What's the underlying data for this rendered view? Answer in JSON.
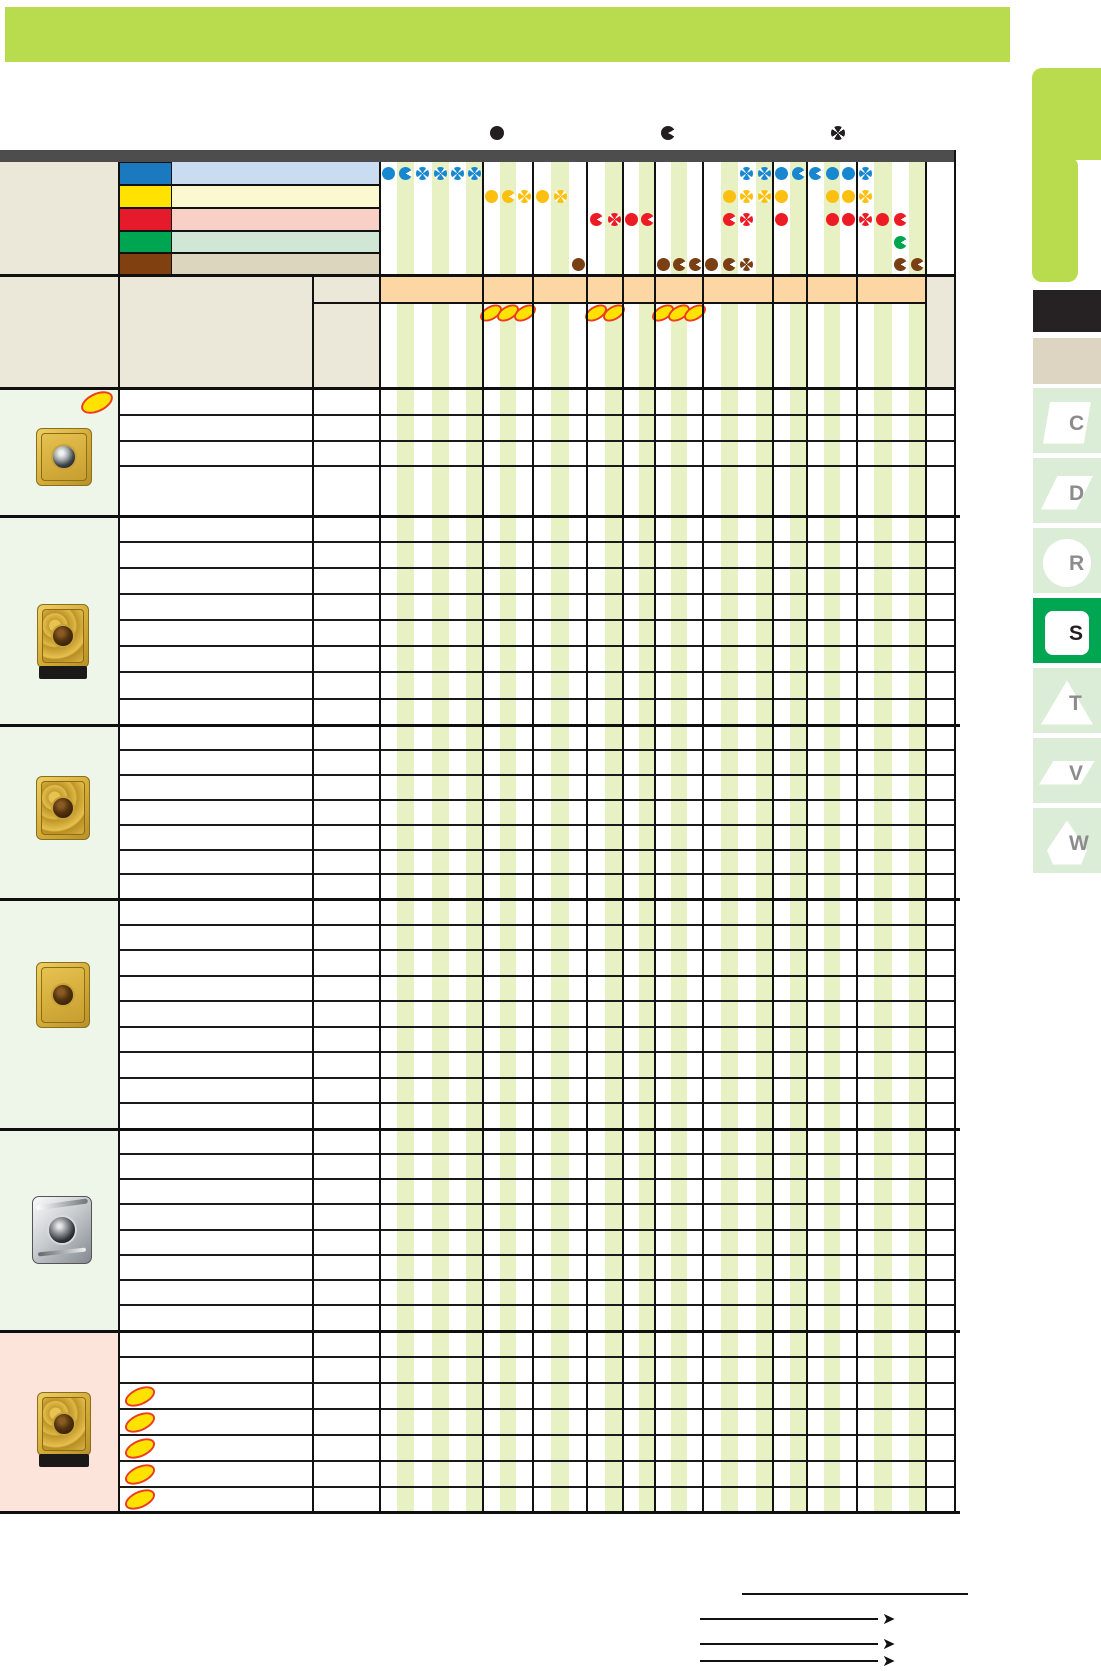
{
  "page": {
    "banner_color": "#b9dc4e",
    "topbar_color": "#4d4d4d",
    "stripe_color": "#e7f1c3",
    "beige_color": "#ebe8da",
    "left_tint_color": "#eef6e9",
    "pink_tint_color": "#fce4db",
    "band_color": "#fcd7a3"
  },
  "legend": {
    "symbols": [
      {
        "name": "first-choice-circle-icon",
        "type": "circle",
        "x": 497
      },
      {
        "name": "second-choice-pacman-icon",
        "type": "pacman",
        "x": 668
      },
      {
        "name": "third-choice-cross-icon",
        "type": "cross",
        "x": 838
      }
    ],
    "color": "#231f20",
    "y": 133,
    "size": 14
  },
  "grid": {
    "groups": [
      6,
      3,
      3,
      2,
      2,
      3,
      4,
      2,
      3,
      4
    ],
    "group_bounds": [
      380,
      483,
      533,
      587,
      623,
      655,
      703,
      773,
      807,
      857,
      926
    ]
  },
  "materials": [
    {
      "id": "blue-row",
      "swatch": "#1b79c0",
      "tint": "#cadcf0",
      "dot_color": "#1787cf",
      "dots": [
        [
          1,
          "circle"
        ],
        [
          2,
          "pacman"
        ],
        [
          3,
          "cross"
        ],
        [
          4,
          "cross"
        ],
        [
          5,
          "cross"
        ],
        [
          6,
          "cross"
        ],
        [
          22,
          "cross"
        ],
        [
          23,
          "cross"
        ],
        [
          24,
          "circle"
        ],
        [
          25,
          "pacman"
        ],
        [
          26,
          "pacman"
        ],
        [
          27,
          "circle"
        ],
        [
          28,
          "circle"
        ],
        [
          29,
          "cross"
        ]
      ]
    },
    {
      "id": "yellow-row",
      "swatch": "#ffe200",
      "tint": "#fcf8cf",
      "dot_color": "#fdc010",
      "dots": [
        [
          7,
          "circle"
        ],
        [
          8,
          "pacman"
        ],
        [
          9,
          "cross"
        ],
        [
          10,
          "circle"
        ],
        [
          11,
          "cross"
        ],
        [
          21,
          "circle"
        ],
        [
          22,
          "cross"
        ],
        [
          23,
          "cross"
        ],
        [
          24,
          "circle"
        ],
        [
          27,
          "circle"
        ],
        [
          28,
          "circle"
        ],
        [
          29,
          "cross"
        ]
      ]
    },
    {
      "id": "red-row",
      "swatch": "#e51b2c",
      "tint": "#f9d0c5",
      "dot_color": "#ed1c24",
      "dots": [
        [
          13,
          "pacman"
        ],
        [
          14,
          "cross"
        ],
        [
          15,
          "circle"
        ],
        [
          16,
          "pacman"
        ],
        [
          21,
          "pacman"
        ],
        [
          22,
          "cross"
        ],
        [
          24,
          "circle"
        ],
        [
          27,
          "circle"
        ],
        [
          28,
          "circle"
        ],
        [
          29,
          "cross"
        ],
        [
          30,
          "circle"
        ],
        [
          31,
          "pacman"
        ]
      ]
    },
    {
      "id": "green-row",
      "swatch": "#00a552",
      "tint": "#cfe7d4",
      "dot_color": "#00a550",
      "dots": [
        [
          31,
          "pacman"
        ]
      ]
    },
    {
      "id": "brown-row",
      "swatch": "#81400f",
      "tint": "#ddd6bf",
      "dot_color": "#7b3f14",
      "dots": [
        [
          12,
          "circle"
        ],
        [
          17,
          "circle"
        ],
        [
          18,
          "pacman"
        ],
        [
          19,
          "pacman"
        ],
        [
          20,
          "circle"
        ],
        [
          21,
          "pacman"
        ],
        [
          22,
          "cross"
        ],
        [
          31,
          "pacman"
        ],
        [
          32,
          "pacman"
        ]
      ]
    }
  ],
  "band": {
    "ellipse_cols": [
      7,
      8,
      9,
      13,
      14,
      17,
      18,
      19
    ],
    "marker_fill": "#ffe200",
    "marker_border": "#ed3b24"
  },
  "sections": [
    {
      "rows": [
        25,
        26,
        25,
        50
      ],
      "tint": "left",
      "insert": "gold-flat",
      "new_marker": true
    },
    {
      "rows": [
        26,
        26,
        26,
        26,
        26,
        26,
        27,
        26
      ],
      "tint": "left",
      "insert": "gold-chipbreaker-base"
    },
    {
      "rows": [
        25,
        25,
        25,
        25,
        25,
        24,
        25
      ],
      "tint": "left",
      "insert": "gold-chipbreaker"
    },
    {
      "rows": [
        26,
        25,
        26,
        25,
        26,
        25,
        26,
        25,
        26
      ],
      "tint": "left",
      "insert": "gold-smooth"
    },
    {
      "rows": [
        25,
        25,
        25,
        26,
        25,
        25,
        25,
        26
      ],
      "tint": "left",
      "insert": "silver"
    },
    {
      "rows": [
        26,
        26,
        26,
        26,
        26,
        26,
        25
      ],
      "tint": "pink",
      "insert": "gold-textured-base",
      "row_markers": [
        2,
        3,
        4,
        5,
        6
      ]
    }
  ],
  "sidebar": {
    "green_tab_color": "#b9dc4e",
    "black_tab_color": "#262223",
    "beige_tab_color": "#ddd5c1",
    "inactive_tab_color": "#dcedd7",
    "active_tab_color": "#00a651",
    "letter_color": "#8c8c8c",
    "active_letter_color": "#231f20",
    "tabs": [
      {
        "letter": "C",
        "shape": "parallelogram",
        "active": false
      },
      {
        "letter": "D",
        "shape": "rhomboid",
        "active": false
      },
      {
        "letter": "R",
        "shape": "circle",
        "active": false
      },
      {
        "letter": "S",
        "shape": "square",
        "active": true
      },
      {
        "letter": "T",
        "shape": "triangle",
        "active": false
      },
      {
        "letter": "V",
        "shape": "thin-parallelogram",
        "active": false
      },
      {
        "letter": "W",
        "shape": "trigon",
        "active": false
      }
    ]
  },
  "footer": {
    "arrow_glyph": "➤",
    "lines": [
      {
        "x": 742,
        "w": 226,
        "y": 1593,
        "arrow": false
      },
      {
        "x": 700,
        "w": 178,
        "y": 1618,
        "arrow": true
      },
      {
        "x": 700,
        "w": 178,
        "y": 1643,
        "arrow": true
      },
      {
        "x": 700,
        "w": 178,
        "y": 1660,
        "arrow": true
      }
    ]
  }
}
